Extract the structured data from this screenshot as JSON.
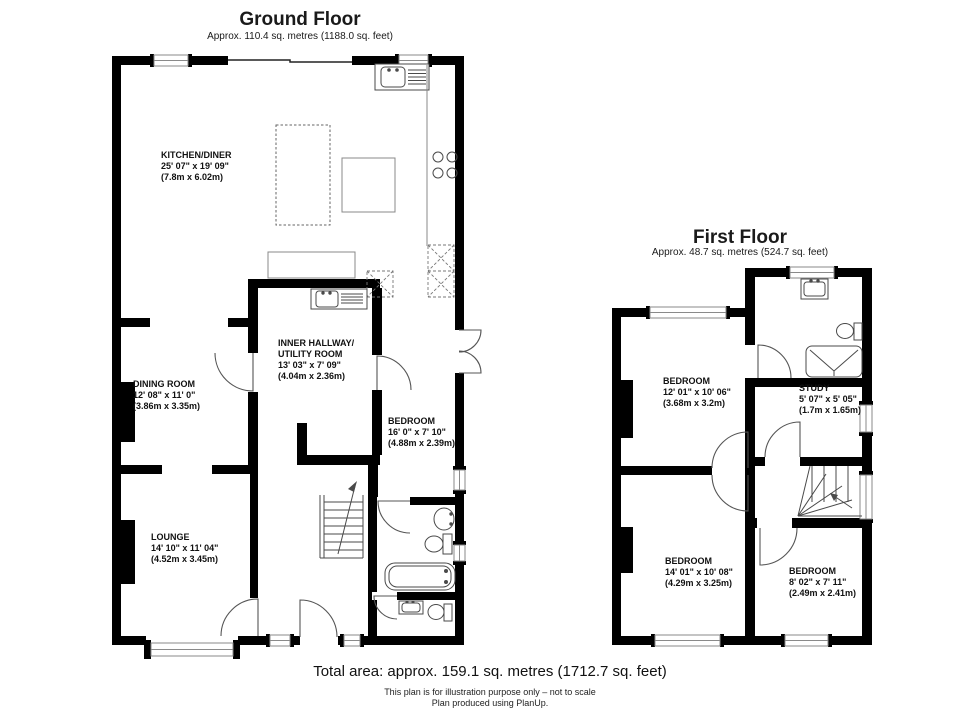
{
  "ground_floor": {
    "title": "Ground Floor",
    "subtitle": "Approx. 110.4 sq. metres (1188.0 sq. feet)",
    "rooms": [
      {
        "name": "KITCHEN/DINER",
        "imperial": "25' 07\" x 19' 09\"",
        "metric": "(7.8m x 6.02m)"
      },
      {
        "name": "INNER HALLWAY/",
        "name2": "UTILITY ROOM",
        "imperial": "13' 03\" x 7' 09\"",
        "metric": "(4.04m x 2.36m)"
      },
      {
        "name": "DINING ROOM",
        "imperial": "12' 08\" x 11' 0\"",
        "metric": "(3.86m x 3.35m)"
      },
      {
        "name": "BEDROOM",
        "imperial": "16' 0\" x 7' 10\"",
        "metric": "(4.88m x 2.39m)"
      },
      {
        "name": "LOUNGE",
        "imperial": "14' 10\" x 11' 04\"",
        "metric": "(4.52m x 3.45m)"
      }
    ]
  },
  "first_floor": {
    "title": "First Floor",
    "subtitle": "Approx. 48.7 sq. metres (524.7 sq. feet)",
    "rooms": [
      {
        "name": "BEDROOM",
        "imperial": "12' 01\" x 10' 06\"",
        "metric": "(3.68m x 3.2m)"
      },
      {
        "name": "STUDY",
        "imperial": "5' 07\" x 5' 05\"",
        "metric": "(1.7m x 1.65m)"
      },
      {
        "name": "BEDROOM",
        "imperial": "14' 01\" x 10' 08\"",
        "metric": "(4.29m x 3.25m)"
      },
      {
        "name": "BEDROOM",
        "imperial": "8' 02\" x 7' 11\"",
        "metric": "(2.49m x 2.41m)"
      }
    ]
  },
  "footer": {
    "total_area": "Total area: approx. 159.1 sq. metres (1712.7 sq. feet)",
    "disclaimer": "This plan is for illustration purpose only – not to scale",
    "produced": "Plan produced using PlanUp."
  },
  "colors": {
    "wall": "#000000",
    "window_border": "#8a8a8a",
    "fixture_line": "#4a4a4a"
  }
}
